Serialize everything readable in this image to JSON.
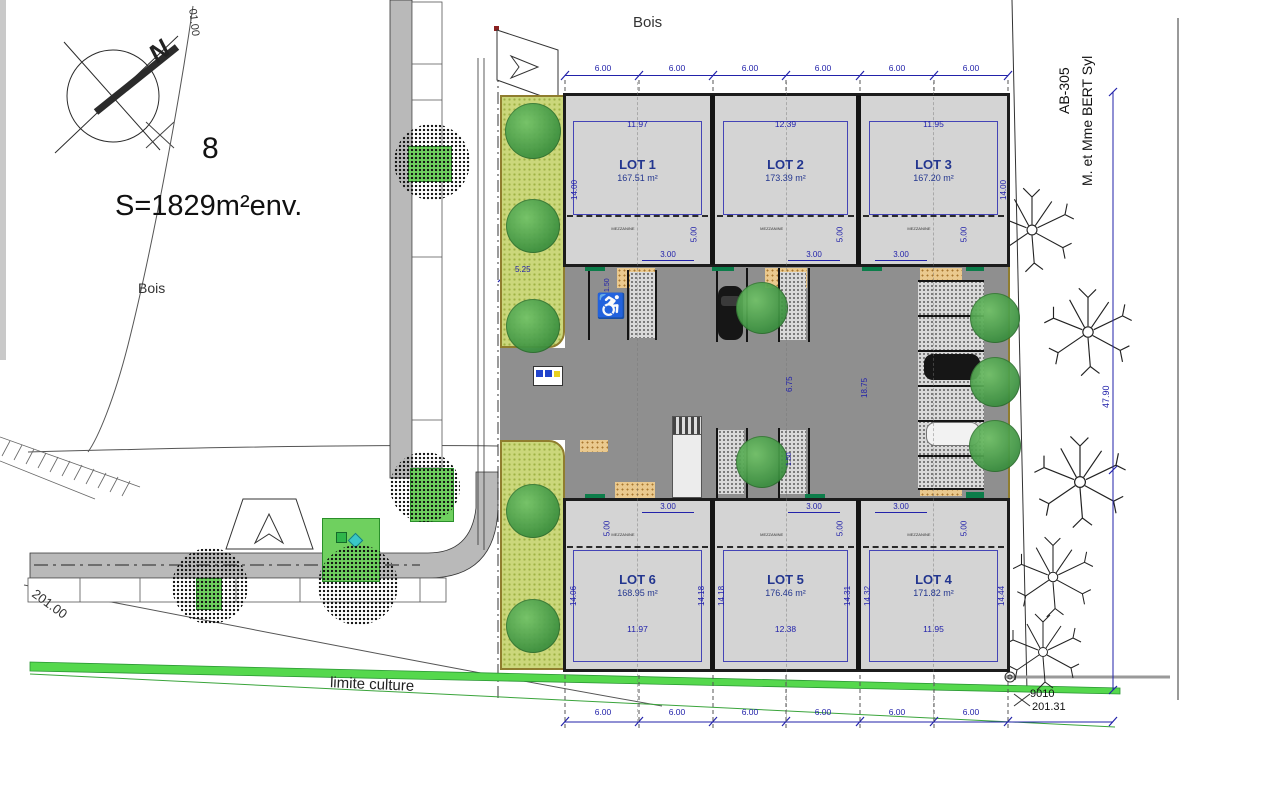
{
  "annotations": {
    "north": "N",
    "parcel_number": "8",
    "surface": "S=1829m²env.",
    "bois_top": "Bois",
    "bois_left": "Bois",
    "contour_top": "01.00",
    "contour_road": "201.00",
    "limite_culture": "limite culture",
    "survey_point_id": "9010",
    "survey_point_level": "201.31",
    "neighbor_parcel": "AB-305",
    "neighbor_owner": "M. et Mme BERT Syl",
    "east_boundary_length": "47.90"
  },
  "icons": {
    "accessible_parking": "♿"
  },
  "dims": {
    "top": [
      "6.00",
      "6.00",
      "6.00",
      "6.00",
      "6.00",
      "6.00"
    ],
    "bottom": [
      "6.00",
      "6.00",
      "6.00",
      "6.00",
      "6.00",
      "6.00"
    ],
    "court_inner_height": "6.75",
    "court_total_height": "18.75",
    "green_strip_width": "5.25",
    "hedge_offset_a": "1.50",
    "hedge_offset_b": "1.50"
  },
  "lots_top": [
    {
      "name": "LOT 1",
      "area": "167.51 m²",
      "width": "11.97",
      "depth": "14.00",
      "mezzanine_depth": "5.00",
      "door_width": "3.00",
      "mezzanine_label": "MEZZANINE"
    },
    {
      "name": "LOT 2",
      "area": "173.39 m²",
      "width": "12.39",
      "mezzanine_depth": "5.00",
      "door_width": "3.00",
      "mezzanine_label": "MEZZANINE"
    },
    {
      "name": "LOT 3",
      "area": "167.20 m²",
      "width": "11.95",
      "depth": "14.00",
      "mezzanine_depth": "5.00",
      "door_width": "3.00",
      "mezzanine_label": "MEZZANINE"
    }
  ],
  "lots_bottom": [
    {
      "name": "LOT 6",
      "area": "168.95 m²",
      "width": "11.97",
      "depth_left": "14.06",
      "depth_right": "14.18",
      "mezzanine_depth": "5.00",
      "door_width": "3.00",
      "mezzanine_label": "MEZZANINE"
    },
    {
      "name": "LOT 5",
      "area": "176.46 m²",
      "width": "12.38",
      "depth_left": "14.18",
      "depth_right": "14.31",
      "mezzanine_depth": "5.00",
      "door_width": "3.00",
      "mezzanine_label": "MEZZANINE"
    },
    {
      "name": "LOT 4",
      "area": "171.82 m²",
      "width": "11.95",
      "depth_left": "14.32",
      "depth_right": "14.44",
      "mezzanine_depth": "5.00",
      "door_width": "3.00",
      "mezzanine_label": "MEZZANINE"
    }
  ]
}
